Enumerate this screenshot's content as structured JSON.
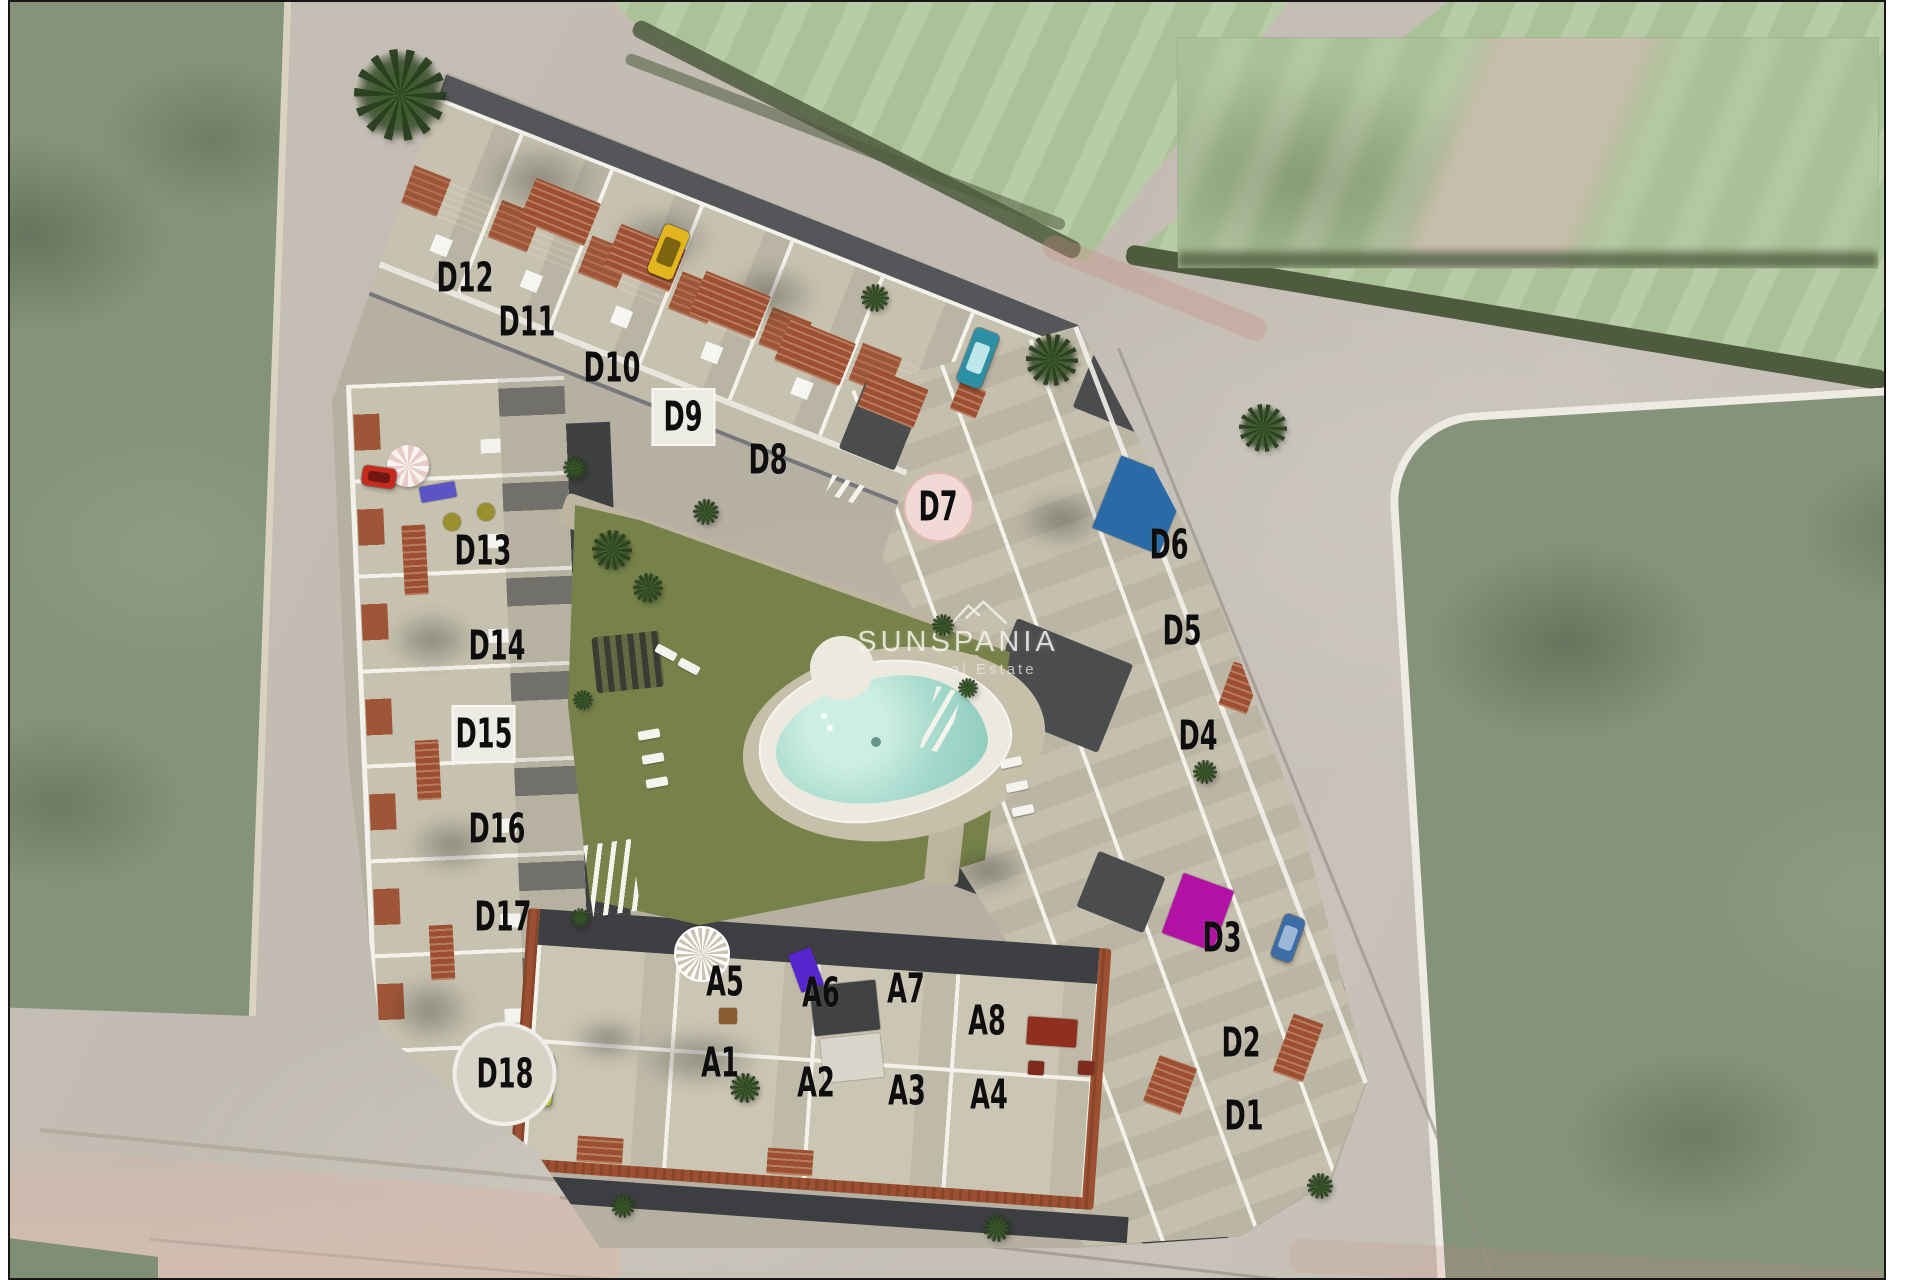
{
  "watermark": {
    "brand": "SUNSPANIA",
    "tagline": "Real Estate"
  },
  "unit_labels": [
    {
      "id": "D12",
      "x": 465,
      "y": 278,
      "bg": "none"
    },
    {
      "id": "D11",
      "x": 527,
      "y": 322,
      "bg": "none"
    },
    {
      "id": "D10",
      "x": 612,
      "y": 368,
      "bg": "none"
    },
    {
      "id": "D9",
      "x": 683,
      "y": 417,
      "bg": "white-square"
    },
    {
      "id": "D8",
      "x": 768,
      "y": 460,
      "bg": "none"
    },
    {
      "id": "D7",
      "x": 938,
      "y": 507,
      "bg": "pink-circle"
    },
    {
      "id": "D6",
      "x": 1169,
      "y": 545,
      "bg": "none"
    },
    {
      "id": "D5",
      "x": 1182,
      "y": 631,
      "bg": "none"
    },
    {
      "id": "D4",
      "x": 1198,
      "y": 736,
      "bg": "none"
    },
    {
      "id": "D3",
      "x": 1222,
      "y": 938,
      "bg": "none"
    },
    {
      "id": "D2",
      "x": 1241,
      "y": 1043,
      "bg": "none"
    },
    {
      "id": "D1",
      "x": 1244,
      "y": 1116,
      "bg": "none"
    },
    {
      "id": "D13",
      "x": 483,
      "y": 551,
      "bg": "none"
    },
    {
      "id": "D14",
      "x": 497,
      "y": 646,
      "bg": "none"
    },
    {
      "id": "D15",
      "x": 484,
      "y": 734,
      "bg": "white-square"
    },
    {
      "id": "D16",
      "x": 497,
      "y": 829,
      "bg": "none"
    },
    {
      "id": "D17",
      "x": 503,
      "y": 917,
      "bg": "none"
    },
    {
      "id": "D18",
      "x": 505,
      "y": 1074,
      "bg": "white-disc"
    },
    {
      "id": "A5",
      "x": 725,
      "y": 982,
      "bg": "none"
    },
    {
      "id": "A6",
      "x": 821,
      "y": 993,
      "bg": "none"
    },
    {
      "id": "A7",
      "x": 906,
      "y": 989,
      "bg": "none"
    },
    {
      "id": "A8",
      "x": 987,
      "y": 1021,
      "bg": "none"
    },
    {
      "id": "A1",
      "x": 720,
      "y": 1063,
      "bg": "none"
    },
    {
      "id": "A2",
      "x": 816,
      "y": 1083,
      "bg": "none"
    },
    {
      "id": "A3",
      "x": 907,
      "y": 1091,
      "bg": "none"
    },
    {
      "id": "A4",
      "x": 989,
      "y": 1095,
      "bg": "none"
    }
  ],
  "vehicles": [
    {
      "name": "yellow-hatchback",
      "x": 668,
      "y": 252,
      "w": 27,
      "h": 52,
      "rot": 22,
      "body": "#e3b51f",
      "glass": "#7c6410"
    },
    {
      "name": "teal-car",
      "x": 978,
      "y": 358,
      "w": 26,
      "h": 58,
      "rot": 21,
      "body": "#2d8fa3",
      "glass": "#bfe6ea"
    },
    {
      "name": "blue-car",
      "x": 1288,
      "y": 938,
      "w": 22,
      "h": 46,
      "rot": 20,
      "body": "#3c6ea5",
      "glass": "#9db8d6"
    },
    {
      "name": "red-car",
      "x": 379,
      "y": 477,
      "w": 34,
      "h": 20,
      "rot": 8,
      "body": "#c62b1e",
      "glass": "#6f1710"
    },
    {
      "name": "lime-car",
      "x": 543,
      "y": 1080,
      "w": 20,
      "h": 52,
      "rot": 4,
      "body": "#b5c13c",
      "glass": "#5e6a1e"
    }
  ],
  "site_features": {
    "colored_markers": [
      {
        "name": "d6-rooftop-pool-marker",
        "x": 1140,
        "y": 505,
        "w": 72,
        "h": 78,
        "rot": 22,
        "color": "#2a6aa6"
      },
      {
        "name": "d3-magenta-marker",
        "x": 1198,
        "y": 912,
        "w": 54,
        "h": 64,
        "rot": 20,
        "color": "#b212a4"
      },
      {
        "name": "a6-purple-marker",
        "x": 806,
        "y": 970,
        "w": 24,
        "h": 40,
        "rot": -20,
        "color": "#5526cc"
      },
      {
        "name": "d13-blue-lounger",
        "x": 438,
        "y": 492,
        "w": 36,
        "h": 16,
        "rot": -10,
        "color": "#5b55c4"
      },
      {
        "name": "garden-dot",
        "x": 452,
        "y": 522,
        "w": 18,
        "h": 18,
        "rot": 0,
        "color": "#9a8f2e",
        "round": true
      },
      {
        "name": "garden-dot",
        "x": 486,
        "y": 512,
        "w": 18,
        "h": 18,
        "rot": 0,
        "color": "#9a8f2e",
        "round": true
      },
      {
        "name": "a7-dark-awning",
        "x": 845,
        "y": 1008,
        "w": 66,
        "h": 50,
        "rot": -6,
        "color": "#3f4143"
      },
      {
        "name": "a3-light-canopy",
        "x": 852,
        "y": 1058,
        "w": 60,
        "h": 44,
        "rot": -6,
        "color": "#d9d6cb"
      },
      {
        "name": "a4-red-table",
        "x": 1052,
        "y": 1032,
        "w": 50,
        "h": 28,
        "rot": 4,
        "color": "#8e2f1f"
      },
      {
        "name": "a4-red-seat",
        "x": 1036,
        "y": 1068,
        "w": 16,
        "h": 14,
        "rot": 4,
        "color": "#7e2a1c"
      },
      {
        "name": "a4-red-seat",
        "x": 1086,
        "y": 1068,
        "w": 16,
        "h": 14,
        "rot": 4,
        "color": "#7e2a1c"
      },
      {
        "name": "a5-table",
        "x": 728,
        "y": 1016,
        "w": 18,
        "h": 16,
        "rot": 0,
        "color": "#8a5a33"
      }
    ],
    "terracotta_patches": [
      [
        560,
        212,
        70,
        46,
        22
      ],
      [
        645,
        258,
        70,
        46,
        22
      ],
      [
        730,
        305,
        70,
        46,
        22
      ],
      [
        815,
        352,
        70,
        46,
        22
      ],
      [
        893,
        398,
        60,
        42,
        22
      ],
      [
        415,
        560,
        24,
        70,
        -3
      ],
      [
        428,
        770,
        24,
        60,
        -3
      ],
      [
        442,
        952,
        24,
        55,
        -3
      ],
      [
        968,
        400,
        28,
        30,
        22
      ],
      [
        1225,
        540,
        36,
        42,
        22
      ],
      [
        1240,
        688,
        30,
        46,
        20
      ],
      [
        1298,
        1048,
        32,
        62,
        20
      ],
      [
        1170,
        1085,
        40,
        50,
        20
      ],
      [
        600,
        1150,
        46,
        26,
        4
      ],
      [
        790,
        1162,
        46,
        26,
        4
      ]
    ],
    "palm_trees": [
      [
        400,
        95,
        46
      ],
      [
        1052,
        360,
        26
      ],
      [
        1263,
        428,
        24
      ],
      [
        612,
        550,
        20
      ],
      [
        648,
        588,
        15
      ],
      [
        706,
        512,
        13
      ],
      [
        943,
        625,
        11
      ],
      [
        968,
        688,
        10
      ],
      [
        575,
        468,
        12
      ],
      [
        583,
        700,
        10
      ],
      [
        580,
        918,
        10
      ],
      [
        997,
        1228,
        14
      ],
      [
        623,
        1206,
        12
      ],
      [
        1320,
        1186,
        13
      ],
      [
        745,
        1088,
        15
      ],
      [
        875,
        298,
        14
      ],
      [
        1205,
        772,
        12
      ]
    ],
    "sun_loungers": [
      [
        638,
        730,
        -10
      ],
      [
        642,
        754,
        -10
      ],
      [
        646,
        778,
        -10
      ],
      [
        1000,
        758,
        -12
      ],
      [
        1006,
        782,
        -12
      ],
      [
        1012,
        806,
        -12
      ],
      [
        655,
        648,
        28
      ],
      [
        678,
        662,
        28
      ]
    ],
    "striped_walkways": [
      [
        588,
        842,
        48,
        72,
        -8
      ],
      [
        928,
        688,
        26,
        64,
        15
      ],
      [
        828,
        480,
        36,
        20,
        20
      ]
    ],
    "building_shadows": [
      [
        540,
        180,
        120,
        80
      ],
      [
        660,
        240,
        110,
        70
      ],
      [
        770,
        295,
        100,
        66
      ],
      [
        432,
        640,
        92,
        62
      ],
      [
        452,
        845,
        92,
        62
      ],
      [
        700,
        1058,
        130,
        64
      ],
      [
        608,
        1040,
        80,
        50
      ],
      [
        1062,
        520,
        90,
        60
      ],
      [
        988,
        870,
        80,
        50
      ],
      [
        430,
        1010,
        90,
        70
      ]
    ]
  },
  "colors": {
    "road": "#c3bdb3",
    "field_sage": "#84937a",
    "field_pale": "#abc298",
    "hedge": "#4e5b3e",
    "site_ground": "#b6b0a3",
    "terrace_beige": "#c7c1af",
    "white_wall": "#f2f1ea",
    "dark_roof": "#4a4c4e",
    "internal_street": "#3e4042",
    "terracotta": "#9d5031",
    "lawn_green": "#76824a",
    "pool_water": "#a3d8cb",
    "pool_deck": "#eceadf",
    "label_text": "#0e0e0e",
    "d7_pink": "#f1d9d5",
    "d6_blue": "#2a6aa6",
    "d3_magenta": "#b212a4",
    "frame_border": "#161616",
    "page_margin": "#ffffff"
  }
}
